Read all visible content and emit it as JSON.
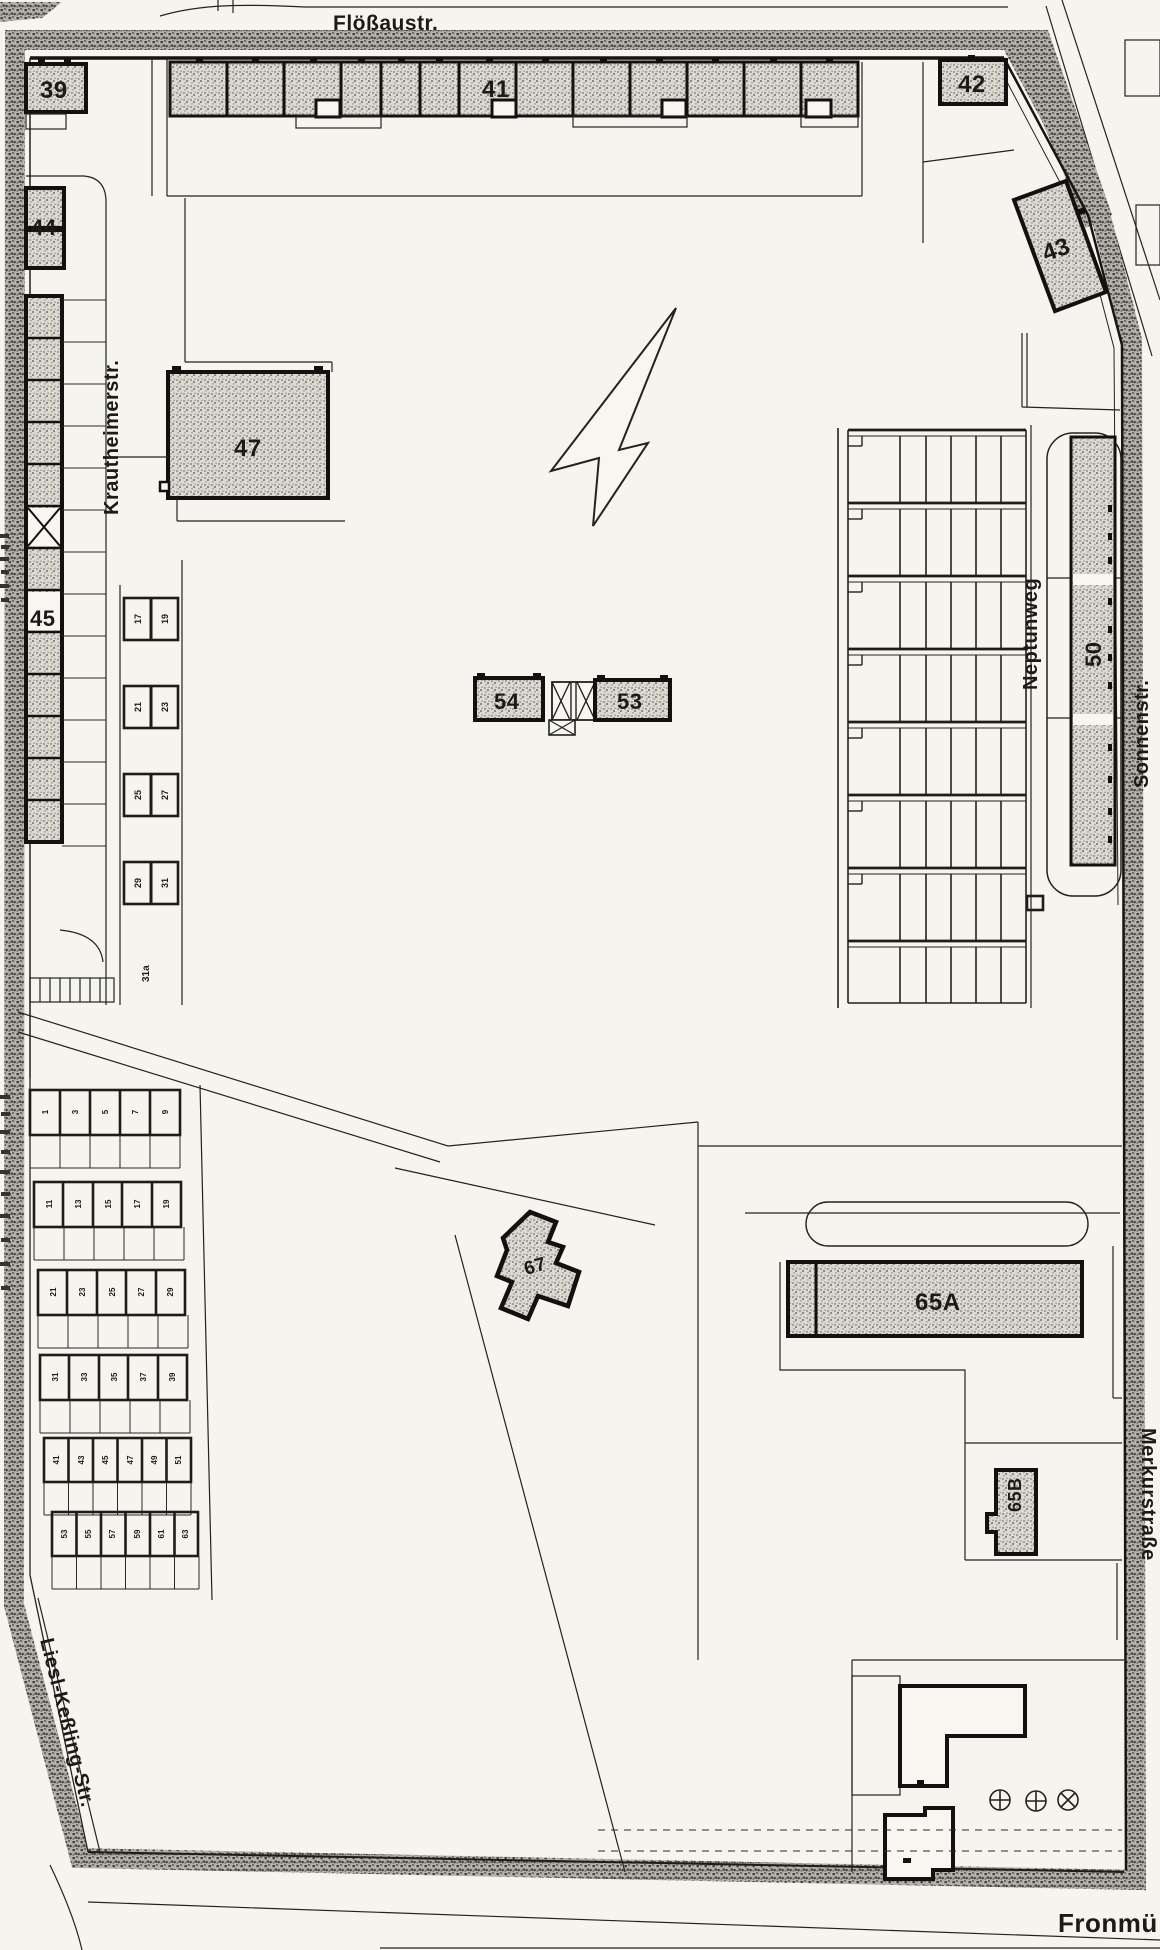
{
  "map": {
    "streets": {
      "top": "Flößaustr.",
      "west_inner": "Krautheimerstr.",
      "east_inner": "Neptunweg",
      "east_outer": "Sonnenstr.",
      "southeast": "Merkurstraße",
      "south": "Fronmü",
      "southwest": "Liesl-Keßling-Str."
    },
    "buildings": {
      "b39": "39",
      "b41": "41",
      "b42": "42",
      "b43": "43",
      "b44": "44",
      "b45": "45",
      "b47": "47",
      "b50": "50",
      "b53": "53",
      "b54": "54",
      "b65a": "65A",
      "b65b": "65B",
      "b67": "67"
    },
    "garage_pairs": {
      "p1": [
        "17",
        "19"
      ],
      "p2": [
        "21",
        "23"
      ],
      "p3": [
        "25",
        "27"
      ],
      "p4": [
        "29",
        "31"
      ]
    },
    "garage_rows": {
      "row1": [
        "1",
        "3",
        "5",
        "7",
        "9"
      ],
      "row2": [
        "11",
        "13",
        "15",
        "17",
        "19"
      ],
      "row3": [
        "21",
        "23",
        "25",
        "27",
        "29"
      ],
      "row4": [
        "31",
        "33",
        "35",
        "37",
        "39"
      ],
      "row5": [
        "41",
        "43",
        "45",
        "47",
        "49",
        "51"
      ],
      "row6": [
        "53",
        "55",
        "57",
        "59",
        "61",
        "63"
      ]
    },
    "annotations": {
      "a31a": "31a"
    },
    "colors": {
      "paper": "#f5f4ee",
      "ink": "#1b1a17",
      "hatch_light": "#dbd9d2",
      "hatch_dark": "#8b8982",
      "band_base": "#b3b1aa",
      "band_dark": "#3f3e3a"
    }
  }
}
